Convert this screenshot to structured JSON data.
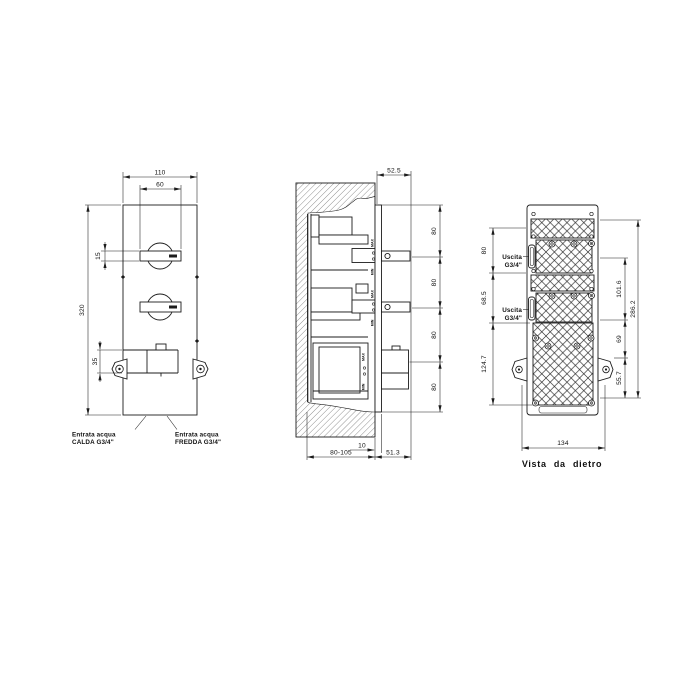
{
  "front_view": {
    "dims": {
      "width_outer": "110",
      "handle_width": "60",
      "height": "320",
      "handle_thickness": "15",
      "inlet_body_height": "35"
    },
    "labels": {
      "hot_line1": "Entrata acqua",
      "hot_line2": "CALDA G3/4\"",
      "cold_line1": "Entrata acqua",
      "cold_line2": "FREDDA G3/4\""
    }
  },
  "side_view": {
    "dims": {
      "handle_protrusion": "52.5",
      "spacing": [
        "80",
        "80",
        "80",
        "80"
      ],
      "plate_thickness": "10",
      "recess_depth": "80-105",
      "front_protrusion": "51.3"
    },
    "marks": {
      "max": "MAX",
      "min": "MIN"
    }
  },
  "back_view": {
    "dims": {
      "outlet_top_offset": "80",
      "outlet_spacing": "68.5",
      "lower_section": "124.7",
      "outlets_span": "101.6",
      "ear_offset": "69",
      "ear_to_bottom": "55.7",
      "total_height": "286.2",
      "width": "134"
    },
    "labels": {
      "outlet1_line1": "Uscita",
      "outlet1_line2": "G3/4\"",
      "outlet2_line1": "Uscita",
      "outlet2_line2": "G3/4\""
    },
    "caption": "Vista da dietro"
  },
  "colors": {
    "line": "#1c1c1c",
    "background": "#ffffff"
  }
}
